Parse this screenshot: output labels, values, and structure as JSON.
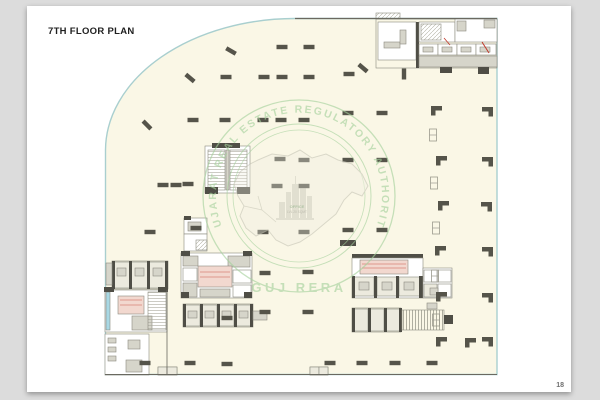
{
  "document": {
    "title": "7TH FLOOR PLAN",
    "page_number": "18"
  },
  "watermark": {
    "ring_text": "GUJARAT REAL ESTATE REGULATORY AUTHORITY",
    "bottom_text": "GUJ RERA",
    "center_label_line1": "OFFICE",
    "center_label_line2": "LVL 20 SQMT",
    "stamp_color": "#a5d19c",
    "map_color": "#c6c5b6"
  },
  "palette": {
    "page_bg": "#dcdcdc",
    "card": "#ffffff",
    "cream": "#faf7e6",
    "teal": "#a9cfcf",
    "wall": "#6a6960",
    "col": "#55544a",
    "g": "#d6d5ca",
    "g2": "#eceade",
    "dg": "#4f4e46",
    "p": "#f2d8cf",
    "c": "#a8d8e4",
    "r": "#c0392b",
    "hatch": "#b3b2a4",
    "roomStroke": "#8b8a7f"
  },
  "plan": {
    "outline": "M 295 18.5 L 497 18.5 L 497 374.5 L 105.5 374.5 L 105.5 150 A 190 132 0 0 1 295 18.5 Z",
    "columns": [
      [
        147,
        125,
        45
      ],
      [
        190,
        78,
        40
      ],
      [
        231,
        51,
        30
      ],
      [
        282,
        47,
        0
      ],
      [
        309,
        47,
        0
      ],
      [
        226,
        77,
        0
      ],
      [
        264,
        77,
        0
      ],
      [
        282,
        77,
        0
      ],
      [
        309,
        77,
        0
      ],
      [
        349,
        74,
        0
      ],
      [
        363,
        68,
        40
      ],
      [
        404,
        74,
        90
      ],
      [
        348,
        113,
        0
      ],
      [
        382,
        113,
        0
      ],
      [
        193,
        120,
        0
      ],
      [
        225,
        120,
        0
      ],
      [
        263,
        120,
        0
      ],
      [
        281,
        120,
        0
      ],
      [
        304,
        120,
        0
      ],
      [
        280,
        159,
        0
      ],
      [
        304,
        160,
        0
      ],
      [
        348,
        160,
        0
      ],
      [
        382,
        160,
        0
      ],
      [
        163,
        185,
        0
      ],
      [
        176,
        185,
        0
      ],
      [
        188,
        184,
        0
      ],
      [
        277,
        186,
        0
      ],
      [
        304,
        186,
        0
      ],
      [
        150,
        232,
        0
      ],
      [
        196,
        228,
        0
      ],
      [
        263,
        232,
        0
      ],
      [
        304,
        232,
        0
      ],
      [
        348,
        230,
        0
      ],
      [
        382,
        230,
        0
      ],
      [
        227,
        318,
        0
      ],
      [
        265,
        273,
        0
      ],
      [
        308,
        272,
        0
      ],
      [
        265,
        312,
        0
      ],
      [
        308,
        312,
        0
      ],
      [
        145,
        363,
        0
      ],
      [
        190,
        363,
        0
      ],
      [
        227,
        364,
        0
      ],
      [
        330,
        363,
        0
      ],
      [
        362,
        363,
        0
      ],
      [
        395,
        363,
        0
      ],
      [
        432,
        363,
        0
      ]
    ],
    "lcols": [
      [
        436,
        110
      ],
      [
        487,
        111
      ],
      [
        441,
        160
      ],
      [
        487,
        161
      ],
      [
        443,
        205
      ],
      [
        486,
        206
      ],
      [
        440,
        250
      ],
      [
        487,
        251
      ],
      [
        441,
        296
      ],
      [
        487,
        297
      ],
      [
        441,
        341
      ],
      [
        470,
        342
      ],
      [
        487,
        341
      ]
    ],
    "smarks": [
      [
        433,
        135
      ],
      [
        434,
        183
      ],
      [
        436,
        228
      ],
      [
        435,
        276
      ],
      [
        436,
        320
      ]
    ],
    "rects": [
      [
        376,
        13,
        24,
        6,
        "h"
      ],
      [
        376,
        19,
        121,
        49,
        "n"
      ],
      [
        378,
        22,
        38,
        38,
        "w"
      ],
      [
        384,
        42,
        16,
        6,
        "g"
      ],
      [
        400,
        30,
        6,
        14,
        "g"
      ],
      [
        416,
        22,
        3,
        46,
        "dg"
      ],
      [
        419,
        22,
        36,
        20,
        "w"
      ],
      [
        421,
        24,
        20,
        16,
        "h"
      ],
      [
        455,
        19,
        42,
        23,
        "w"
      ],
      [
        457,
        21,
        9,
        10,
        "g"
      ],
      [
        484,
        20,
        11,
        8,
        "g"
      ],
      [
        419,
        44,
        19,
        11,
        "w"
      ],
      [
        438,
        44,
        19,
        11,
        "w"
      ],
      [
        457,
        44,
        19,
        11,
        "w"
      ],
      [
        476,
        44,
        20,
        11,
        "w"
      ],
      [
        423,
        47,
        10,
        5,
        "g"
      ],
      [
        442,
        47,
        10,
        5,
        "g"
      ],
      [
        461,
        47,
        10,
        5,
        "g"
      ],
      [
        480,
        47,
        10,
        5,
        "g"
      ],
      [
        419,
        56,
        78,
        11,
        "g"
      ],
      [
        440,
        67,
        12,
        6,
        "dg"
      ],
      [
        478,
        67,
        11,
        7,
        "dg"
      ],
      [
        205,
        146,
        45,
        47,
        "w"
      ],
      [
        212,
        143,
        28,
        5,
        "dg"
      ],
      [
        208,
        150,
        17,
        40,
        "hh"
      ],
      [
        230,
        150,
        17,
        40,
        "hh"
      ],
      [
        226,
        150,
        3,
        40,
        "g"
      ],
      [
        205,
        187,
        13,
        7,
        "dg"
      ],
      [
        237,
        187,
        13,
        7,
        "dg"
      ],
      [
        184,
        218,
        23,
        16,
        "w"
      ],
      [
        184,
        234,
        23,
        17,
        "w"
      ],
      [
        188,
        222,
        13,
        9,
        "g"
      ],
      [
        196,
        240,
        11,
        10,
        "h"
      ],
      [
        184,
        216,
        7,
        4,
        "dg"
      ],
      [
        181,
        253,
        71,
        45,
        "w"
      ],
      [
        183,
        256,
        15,
        10,
        "g"
      ],
      [
        228,
        256,
        22,
        11,
        "g"
      ],
      [
        198,
        266,
        34,
        21,
        "p"
      ],
      [
        183,
        268,
        14,
        13,
        "w"
      ],
      [
        183,
        283,
        14,
        14,
        "g"
      ],
      [
        233,
        270,
        18,
        13,
        "w"
      ],
      [
        233,
        285,
        18,
        12,
        "w"
      ],
      [
        200,
        289,
        30,
        8,
        "g"
      ],
      [
        181,
        251,
        9,
        5,
        "dg"
      ],
      [
        243,
        251,
        9,
        5,
        "dg"
      ],
      [
        181,
        292,
        8,
        6,
        "dg"
      ],
      [
        244,
        292,
        8,
        6,
        "dg"
      ],
      [
        183,
        304,
        70,
        23,
        "n"
      ],
      [
        184,
        305,
        16,
        21,
        "g2"
      ],
      [
        201,
        305,
        16,
        21,
        "g2"
      ],
      [
        218,
        305,
        16,
        21,
        "g2"
      ],
      [
        235,
        305,
        16,
        21,
        "g2"
      ],
      [
        188,
        311,
        9,
        7,
        "g"
      ],
      [
        205,
        311,
        9,
        7,
        "g"
      ],
      [
        222,
        311,
        9,
        7,
        "g"
      ],
      [
        239,
        311,
        9,
        7,
        "g"
      ],
      [
        183,
        304,
        3,
        23,
        "dg"
      ],
      [
        200,
        304,
        3,
        23,
        "dg"
      ],
      [
        217,
        304,
        3,
        23,
        "dg"
      ],
      [
        234,
        304,
        3,
        23,
        "dg"
      ],
      [
        250,
        304,
        3,
        23,
        "dg"
      ],
      [
        253,
        311,
        14,
        9,
        "g"
      ],
      [
        112,
        261,
        56,
        28,
        "n"
      ],
      [
        113,
        262,
        17,
        26,
        "g2"
      ],
      [
        131,
        262,
        17,
        26,
        "g2"
      ],
      [
        149,
        262,
        17,
        26,
        "g2"
      ],
      [
        117,
        268,
        9,
        8,
        "g"
      ],
      [
        135,
        268,
        9,
        8,
        "g"
      ],
      [
        153,
        268,
        9,
        8,
        "g"
      ],
      [
        112,
        261,
        3,
        28,
        "dg"
      ],
      [
        129,
        261,
        3,
        28,
        "dg"
      ],
      [
        147,
        261,
        3,
        28,
        "dg"
      ],
      [
        165,
        261,
        3,
        28,
        "dg"
      ],
      [
        106,
        263,
        6,
        22,
        "g"
      ],
      [
        105,
        290,
        62,
        42,
        "w"
      ],
      [
        106,
        292,
        4,
        38,
        "c"
      ],
      [
        118,
        296,
        26,
        18,
        "p"
      ],
      [
        132,
        316,
        20,
        14,
        "g"
      ],
      [
        148,
        292,
        18,
        38,
        "hh"
      ],
      [
        104,
        287,
        10,
        5,
        "dg"
      ],
      [
        158,
        287,
        10,
        5,
        "dg"
      ],
      [
        105,
        334,
        44,
        41,
        "w"
      ],
      [
        108,
        338,
        8,
        5,
        "g"
      ],
      [
        108,
        347,
        8,
        5,
        "g"
      ],
      [
        108,
        356,
        8,
        5,
        "g"
      ],
      [
        128,
        340,
        12,
        9,
        "g"
      ],
      [
        126,
        360,
        16,
        12,
        "g"
      ],
      [
        158,
        367,
        19,
        8,
        "n"
      ],
      [
        158,
        367,
        9,
        8,
        "g2"
      ],
      [
        167,
        367,
        10,
        8,
        "g2"
      ],
      [
        340,
        240,
        16,
        6,
        "dg"
      ],
      [
        352,
        254,
        71,
        4,
        "dg"
      ],
      [
        352,
        258,
        71,
        40,
        "w"
      ],
      [
        360,
        260,
        48,
        14,
        "p"
      ],
      [
        354,
        277,
        20,
        19,
        "g2"
      ],
      [
        377,
        277,
        20,
        19,
        "g2"
      ],
      [
        399,
        277,
        21,
        19,
        "g2"
      ],
      [
        359,
        282,
        10,
        8,
        "g"
      ],
      [
        382,
        282,
        10,
        8,
        "g"
      ],
      [
        404,
        282,
        10,
        8,
        "g"
      ],
      [
        352,
        276,
        3,
        22,
        "dg"
      ],
      [
        374,
        276,
        3,
        22,
        "dg"
      ],
      [
        396,
        276,
        3,
        22,
        "dg"
      ],
      [
        419,
        276,
        4,
        22,
        "dg"
      ],
      [
        423,
        268,
        29,
        30,
        "w"
      ],
      [
        424,
        270,
        13,
        12,
        "w"
      ],
      [
        438,
        270,
        13,
        12,
        "w"
      ],
      [
        424,
        284,
        13,
        13,
        "g2"
      ],
      [
        438,
        284,
        13,
        13,
        "w"
      ],
      [
        430,
        288,
        8,
        7,
        "g"
      ],
      [
        352,
        308,
        49,
        24,
        "n"
      ],
      [
        353,
        309,
        15,
        22,
        "g2"
      ],
      [
        369,
        309,
        15,
        22,
        "g2"
      ],
      [
        385,
        309,
        15,
        22,
        "g2"
      ],
      [
        352,
        308,
        3,
        24,
        "dg"
      ],
      [
        368,
        308,
        3,
        24,
        "dg"
      ],
      [
        384,
        308,
        3,
        24,
        "dg"
      ],
      [
        399,
        308,
        3,
        24,
        "dg"
      ],
      [
        402,
        310,
        42,
        20,
        "hv"
      ],
      [
        444,
        315,
        9,
        9,
        "dg"
      ],
      [
        427,
        303,
        10,
        6,
        "g"
      ],
      [
        310,
        367,
        18,
        8,
        "n"
      ],
      [
        310,
        367,
        9,
        8,
        "g2"
      ],
      [
        319,
        367,
        9,
        8,
        "g2"
      ]
    ],
    "lines": [
      [
        295,
        18.5,
        497,
        18.5,
        "k",
        1.2
      ],
      [
        105,
        374.5,
        497,
        374.5,
        "k",
        1
      ],
      [
        167,
        290,
        167,
        374,
        "k",
        0.8
      ],
      [
        482,
        42,
        489,
        53,
        "r",
        1
      ],
      [
        444,
        38,
        450,
        45,
        "r",
        0.8
      ],
      [
        200,
        272,
        230,
        272,
        "r",
        0.4
      ],
      [
        200,
        277,
        230,
        277,
        "r",
        0.4
      ],
      [
        362,
        264,
        406,
        264,
        "r",
        0.4
      ],
      [
        362,
        268,
        406,
        268,
        "r",
        0.4
      ],
      [
        120,
        300,
        142,
        300,
        "r",
        0.4
      ],
      [
        120,
        305,
        142,
        305,
        "r",
        0.4
      ]
    ]
  }
}
